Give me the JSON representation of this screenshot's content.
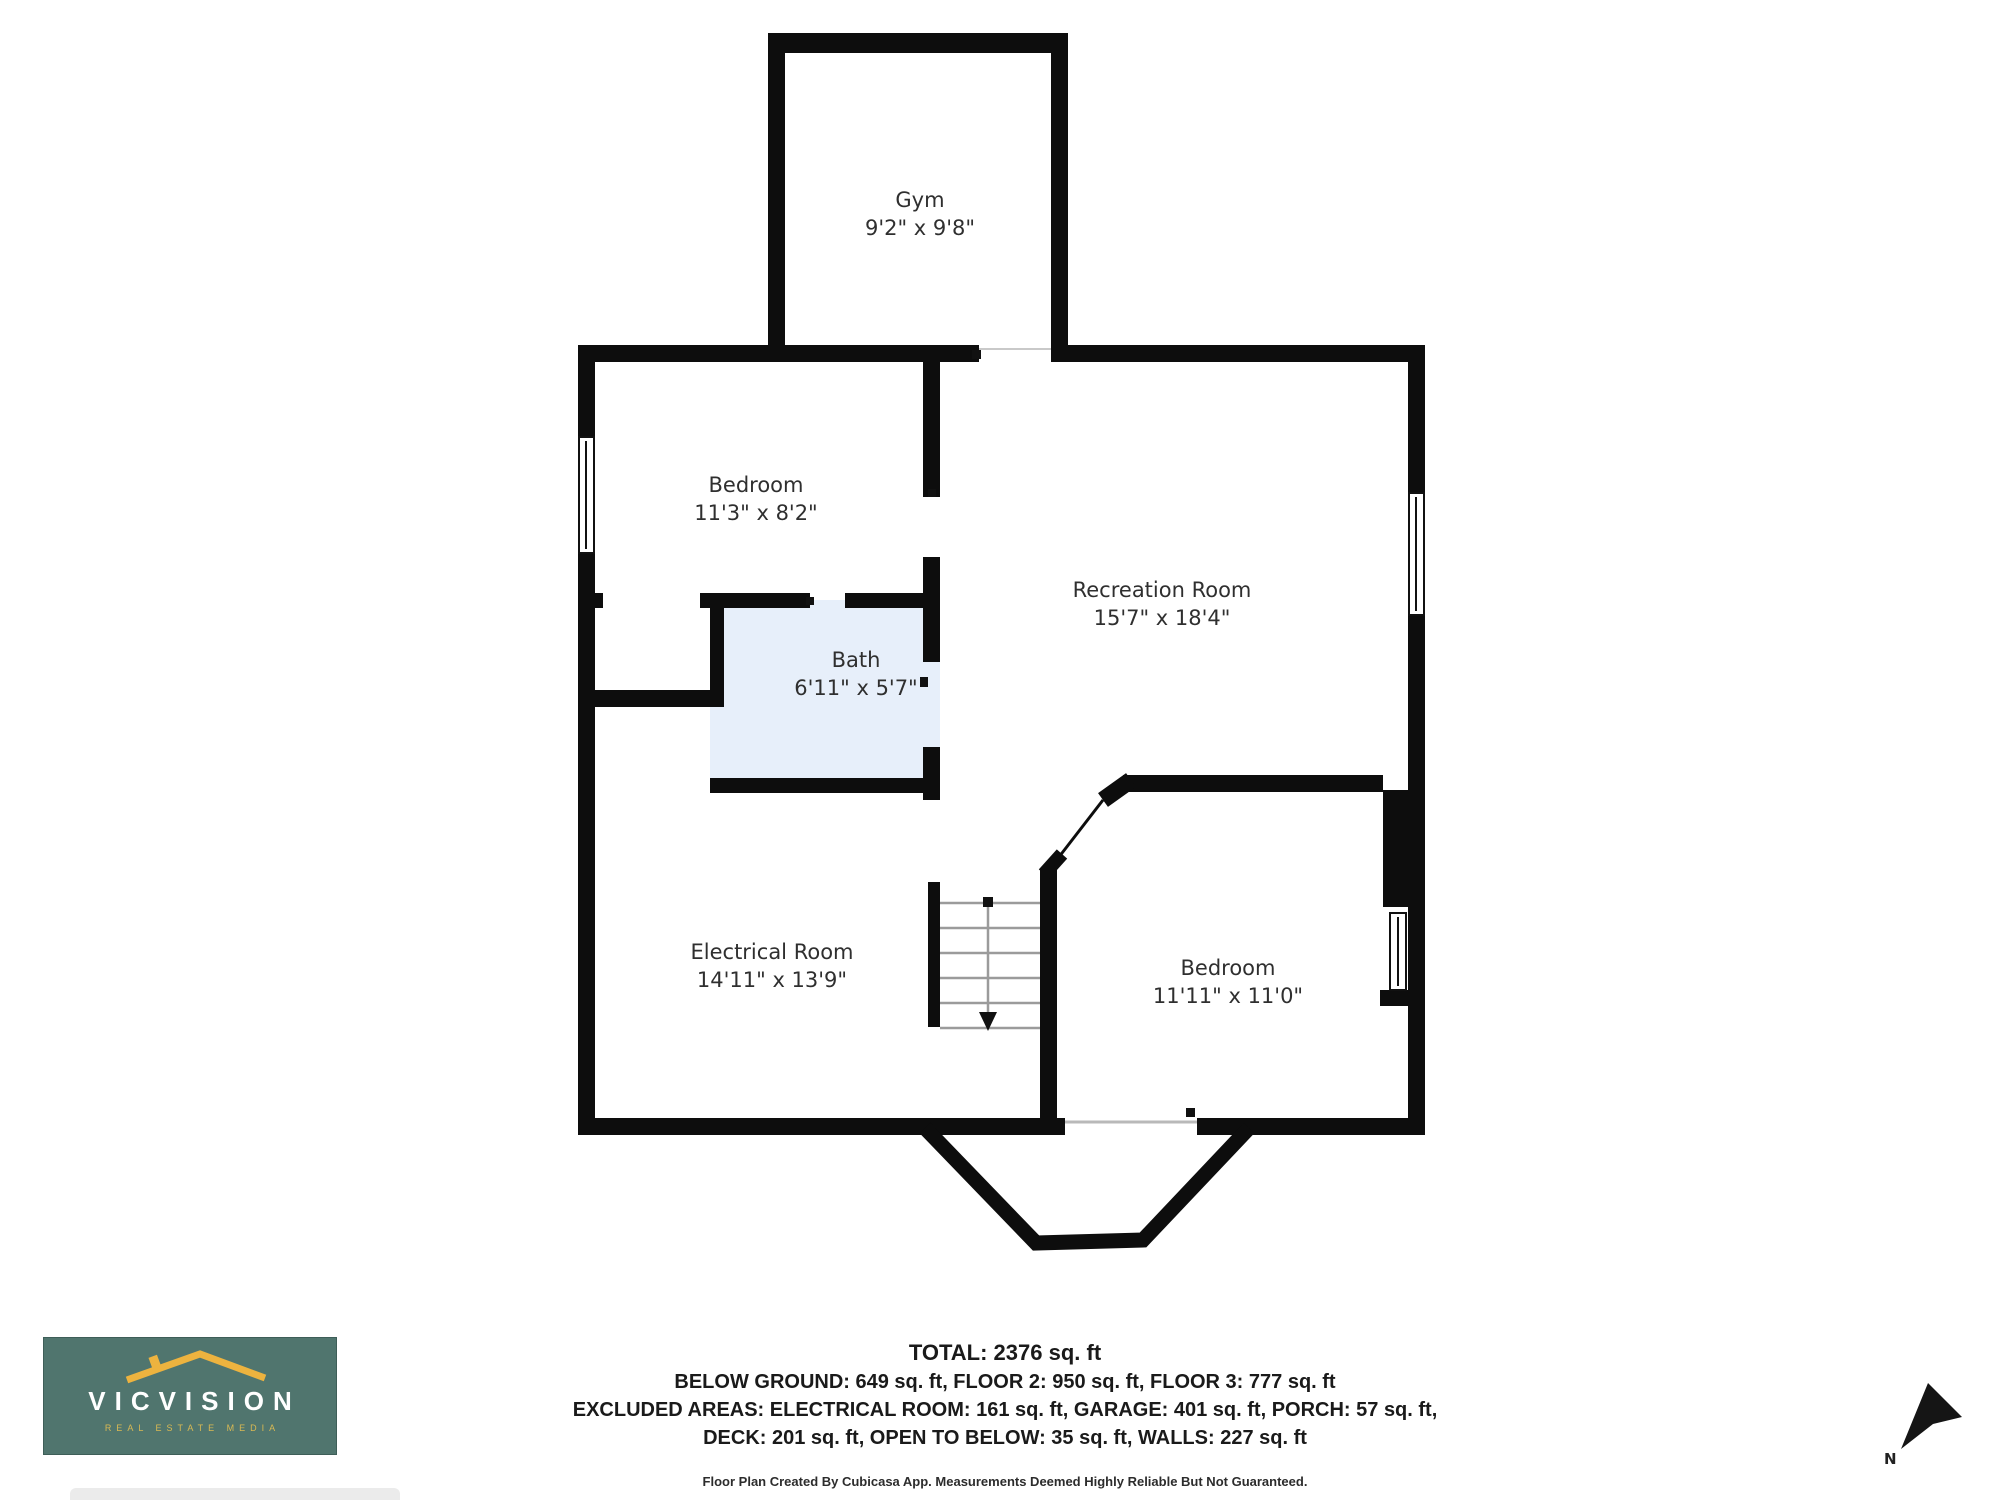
{
  "rooms": [
    {
      "name": "Gym",
      "dims": "9'2\" x 9'8\""
    },
    {
      "name": "Bedroom",
      "dims": "11'3\" x 8'2\""
    },
    {
      "name": "Recreation Room",
      "dims": "15'7\" x 18'4\""
    },
    {
      "name": "Bath",
      "dims": "6'11\" x 5'7\""
    },
    {
      "name": "Electrical Room",
      "dims": "14'11\" x 13'9\""
    },
    {
      "name": "Bedroom",
      "dims": "11'11\" x 11'0\""
    }
  ],
  "footer": {
    "total": "TOTAL: 2376 sq. ft",
    "line2": "BELOW GROUND: 649 sq. ft, FLOOR 2: 950 sq. ft, FLOOR 3: 777 sq. ft",
    "line3": "EXCLUDED AREAS: ELECTRICAL ROOM: 161 sq. ft, GARAGE: 401 sq. ft, PORCH: 57 sq. ft,",
    "line4": "DECK: 201 sq. ft, OPEN TO BELOW: 35 sq. ft, WALLS: 227 sq. ft",
    "credit": "Floor Plan Created By Cubicasa App. Measurements Deemed Highly Reliable But Not Guaranteed."
  },
  "logo": {
    "brand": "VICVISION",
    "tagline": "REAL ESTATE MEDIA",
    "background": "#50756e",
    "roof_color": "#edb33f",
    "text_color": "#ffffff",
    "tagline_color": "#d9b953"
  },
  "compass": {
    "label": "N"
  },
  "colors": {
    "wall": "#0d0d0d",
    "bath_fill": "#e7effa",
    "stair_tread": "#9b9b9b",
    "label_text": "#2f2f2f"
  }
}
